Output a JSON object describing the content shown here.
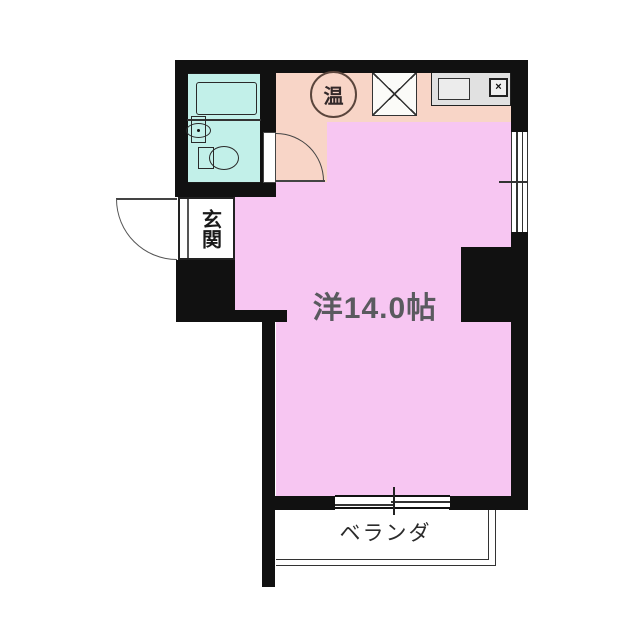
{
  "floor_plan": {
    "room": {
      "label": "洋14.0帖"
    },
    "entrance": {
      "label": "玄関"
    },
    "balcony": {
      "label": "ベランダ"
    },
    "water_heater": {
      "label": "温"
    },
    "stove": {
      "glyph": "×"
    }
  },
  "colors": {
    "wall": "#111111",
    "room_fill": "#f7c6f2",
    "kitchen_fill": "#f8d5c7",
    "bathroom_fill": "#c2f0e9",
    "counter_fill": "#e1e1e1",
    "line": "#333333",
    "room_text": "#5a5a5f"
  }
}
